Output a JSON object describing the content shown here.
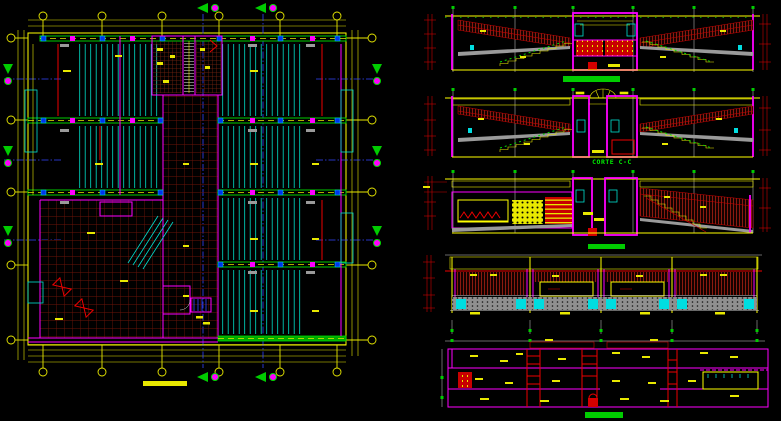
{
  "sheet": {
    "kind": "CAD architectural drawing sheet",
    "background": "#000000",
    "width_px": 781,
    "height_px": 421
  },
  "palette": {
    "grid_and_dimensions": "#ffff00",
    "walls": "#ff00ff",
    "section_marks": "#00dd00",
    "seating_hatch": "#00e0d0",
    "tile_hatch": "#6b1408",
    "roof_hatch": "#8a1a10",
    "alert_red": "#ee0000",
    "axis_blue": "#3344ff",
    "annotation_gray": "#9a9a9a"
  },
  "icons": {
    "grid_bubble": "yellow axis circle marker",
    "section_marker": "green arrow with magenta circle",
    "stair_hatch": "parallel rung lines",
    "bowtie_symbol": "red hourglass door symbol"
  },
  "drawings": [
    {
      "id": "floor-plan",
      "kind": "plan",
      "title_style": "yellow-bar",
      "title_text": ""
    },
    {
      "id": "section-1",
      "kind": "section",
      "title_style": "green-bar",
      "title_text": ""
    },
    {
      "id": "section-2",
      "kind": "section",
      "title_style": "green-text",
      "title_text": "CORTE C-C"
    },
    {
      "id": "section-3",
      "kind": "section",
      "title_style": "green-bar",
      "title_text": ""
    },
    {
      "id": "elevation-1",
      "kind": "elevation",
      "title_style": "none",
      "title_text": ""
    },
    {
      "id": "section-4",
      "kind": "section",
      "title_style": "green-bar",
      "title_text": ""
    }
  ]
}
